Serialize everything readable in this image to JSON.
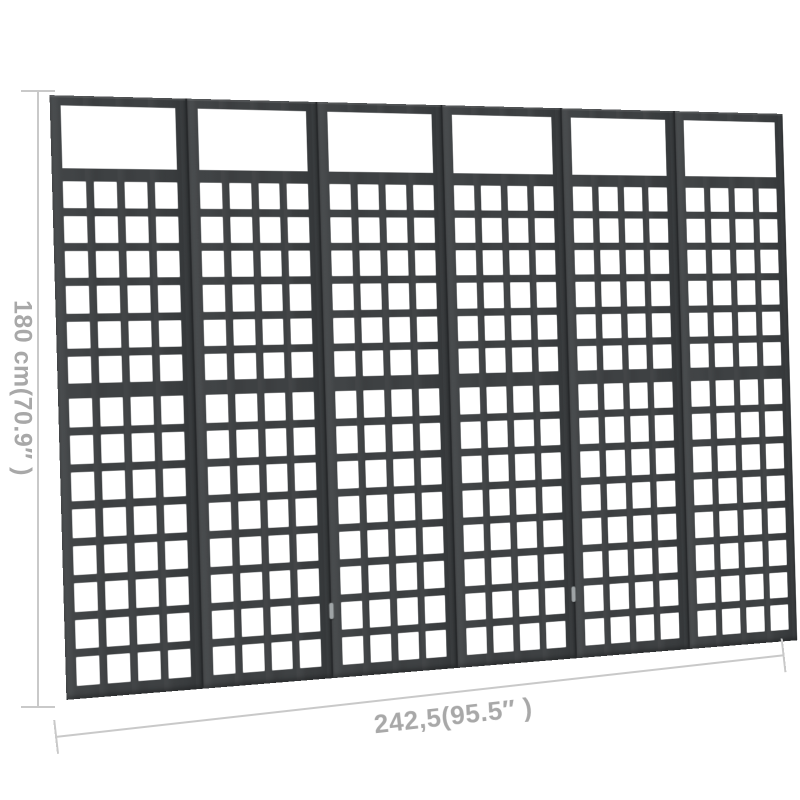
{
  "annotations": {
    "height_label": "180 cm(70.9″ )",
    "width_label": "242,5(95.5″ )",
    "line_color": "#c9c9c9",
    "text_color": "#a8a8a8"
  },
  "divider": {
    "panel_count": 6,
    "columns_per_panel": 4,
    "upper_rows": 6,
    "lower_rows": 8,
    "wood_color": "#3e4143",
    "wood_light": "#484b4d",
    "wood_dark": "#333638",
    "seam_color": "#26282a",
    "hole_color": "#ffffff",
    "hinge_color": "#9fa4a6",
    "hinges": [
      {
        "seam_index": 2,
        "top_pct": 87
      },
      {
        "seam_index": 4,
        "top_pct": 87
      }
    ]
  },
  "page": {
    "background": "#ffffff"
  }
}
